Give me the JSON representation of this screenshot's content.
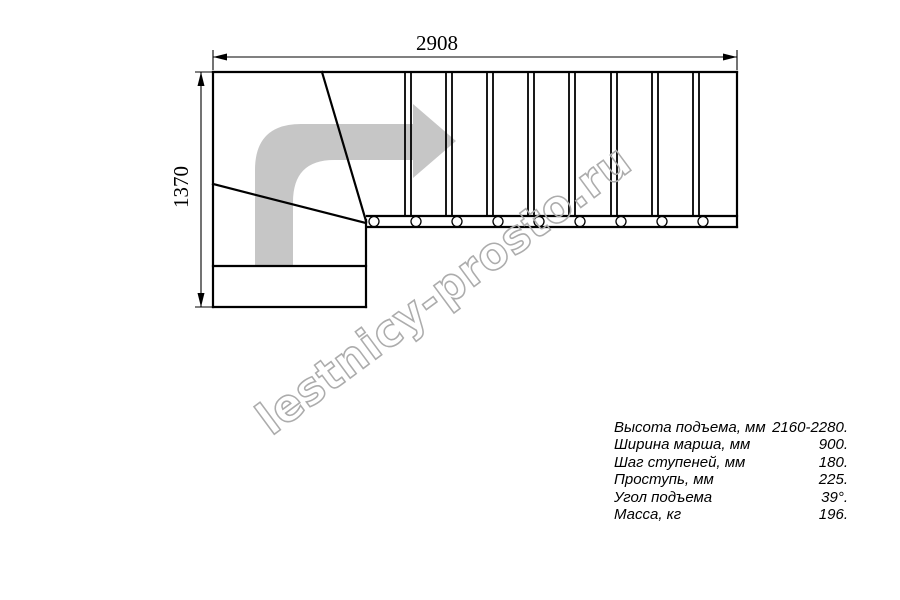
{
  "page": {
    "background": "#ffffff"
  },
  "drawing": {
    "type": "staircase-plan-top-view",
    "straight_steps": 9,
    "winder_steps": 3,
    "baluster_count": 9,
    "line_color": "#000000",
    "direction_arrow_color": "#c6c6c6"
  },
  "dimensions": {
    "width": {
      "value": "2908"
    },
    "height": {
      "value": "1370"
    }
  },
  "watermark": {
    "text": "lestnicy-prosto.ru",
    "color": "#acacac"
  },
  "specs": {
    "rows": [
      {
        "label": "Высота подъема, мм",
        "value": "2160-2280."
      },
      {
        "label": "Ширина марша, мм",
        "value": "900."
      },
      {
        "label": "Шаг ступеней, мм",
        "value": "180."
      },
      {
        "label": "Проступь, мм",
        "value": "225."
      },
      {
        "label": "Угол подъема",
        "value": "39°."
      },
      {
        "label": "Масса, кг",
        "value": "196."
      }
    ]
  }
}
